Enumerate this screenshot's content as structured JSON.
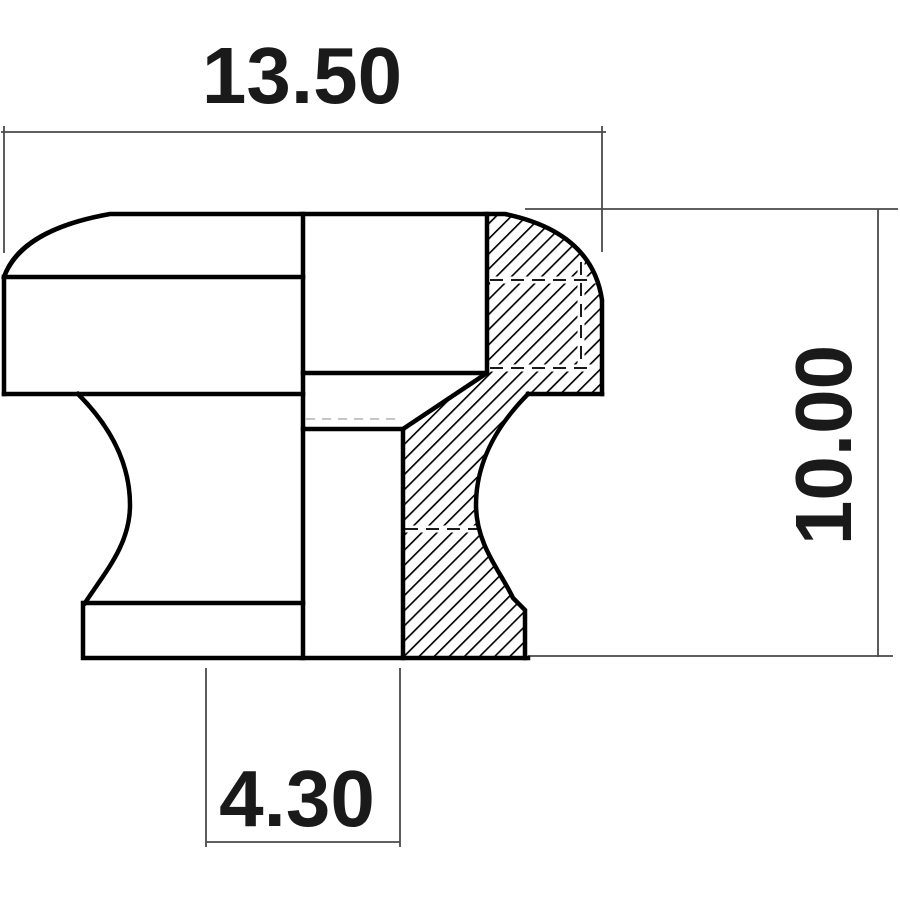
{
  "drawing": {
    "description": "Technical half-section drawing of a round knob / strap button",
    "view": "front cross-section, right half hatched",
    "labels": {
      "width": "13.50",
      "height": "10.00",
      "hole_diameter": "4.30"
    },
    "colors": {
      "outline": "#000000",
      "hatch": "#000000",
      "dimension_lines": "#4a4a4a",
      "text": "#1a1a1a",
      "background": "#ffffff"
    }
  }
}
